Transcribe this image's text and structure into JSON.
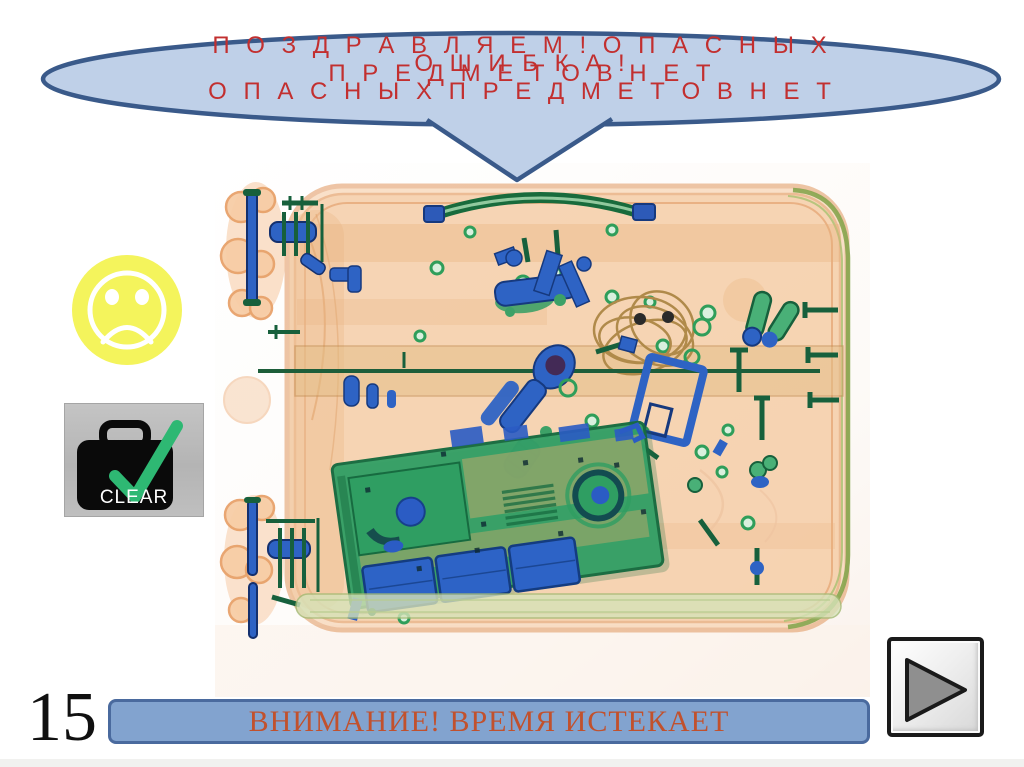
{
  "callout": {
    "congrats_line1": "П О З Д Р А В Л Я Е М !  О П А С Н Ы Х",
    "congrats_line2": "П Р Е Д М Е Т О В  Н Е Т",
    "error_line1": "О Ш И Б К А !",
    "error_line2": "О П А С Н Ы Х  П Р Е Д М Е Т О В  Н Е Т",
    "fill_color": "#bfd0e8",
    "border_color": "#3a5a8a",
    "text_color": "#c22f2f"
  },
  "feedback": {
    "sad_face_icon": "sad-face-icon",
    "sad_face_color": "#f4f45c",
    "clear_label": "CLEAR",
    "clear_icon": "suitcase-check-icon",
    "check_color": "#2eb873"
  },
  "xray_image": {
    "icon": "xray-suitcase-image",
    "contents": [
      "suitcase",
      "handle",
      "wheels",
      "screws",
      "tools",
      "wire-coil",
      "blue-frame",
      "laptop-circuit-board",
      "batteries"
    ]
  },
  "timer": {
    "value": "15"
  },
  "warning_bar": {
    "label": "ВНИМАНИЕ! ВРЕМЯ ИСТЕКАЕТ",
    "fill_color": "#82a3cf",
    "border_color": "#4a6a9e",
    "text_color": "#c1512d"
  },
  "next_button": {
    "icon": "play-icon"
  }
}
